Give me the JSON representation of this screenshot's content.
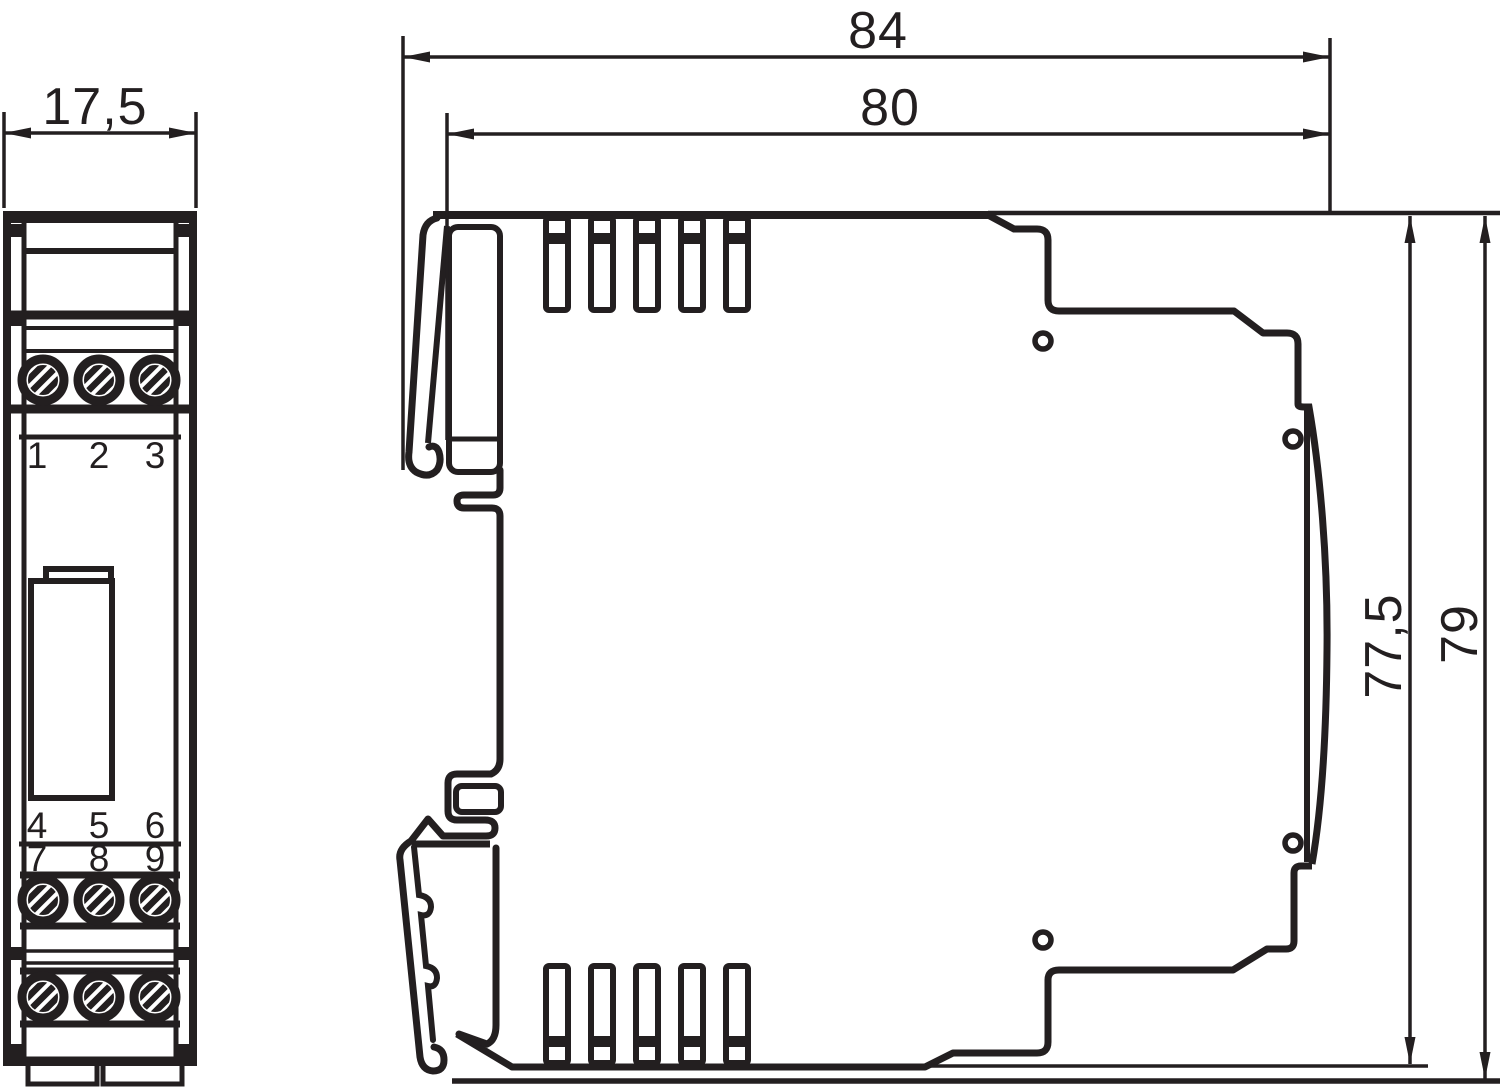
{
  "front_view": {
    "width_dimension_label": "17,5",
    "terminal_numbers_top": [
      "1",
      "2",
      "3"
    ],
    "terminal_numbers_middle": [
      "4",
      "5",
      "6"
    ],
    "terminal_numbers_bottom": [
      "7",
      "8",
      "9"
    ]
  },
  "side_view": {
    "overall_depth_label": "84",
    "body_depth_label": "80",
    "body_height_label": "77,5",
    "overall_height_label": "79"
  },
  "colors": {
    "ink": "#231f20",
    "background": "#ffffff"
  }
}
